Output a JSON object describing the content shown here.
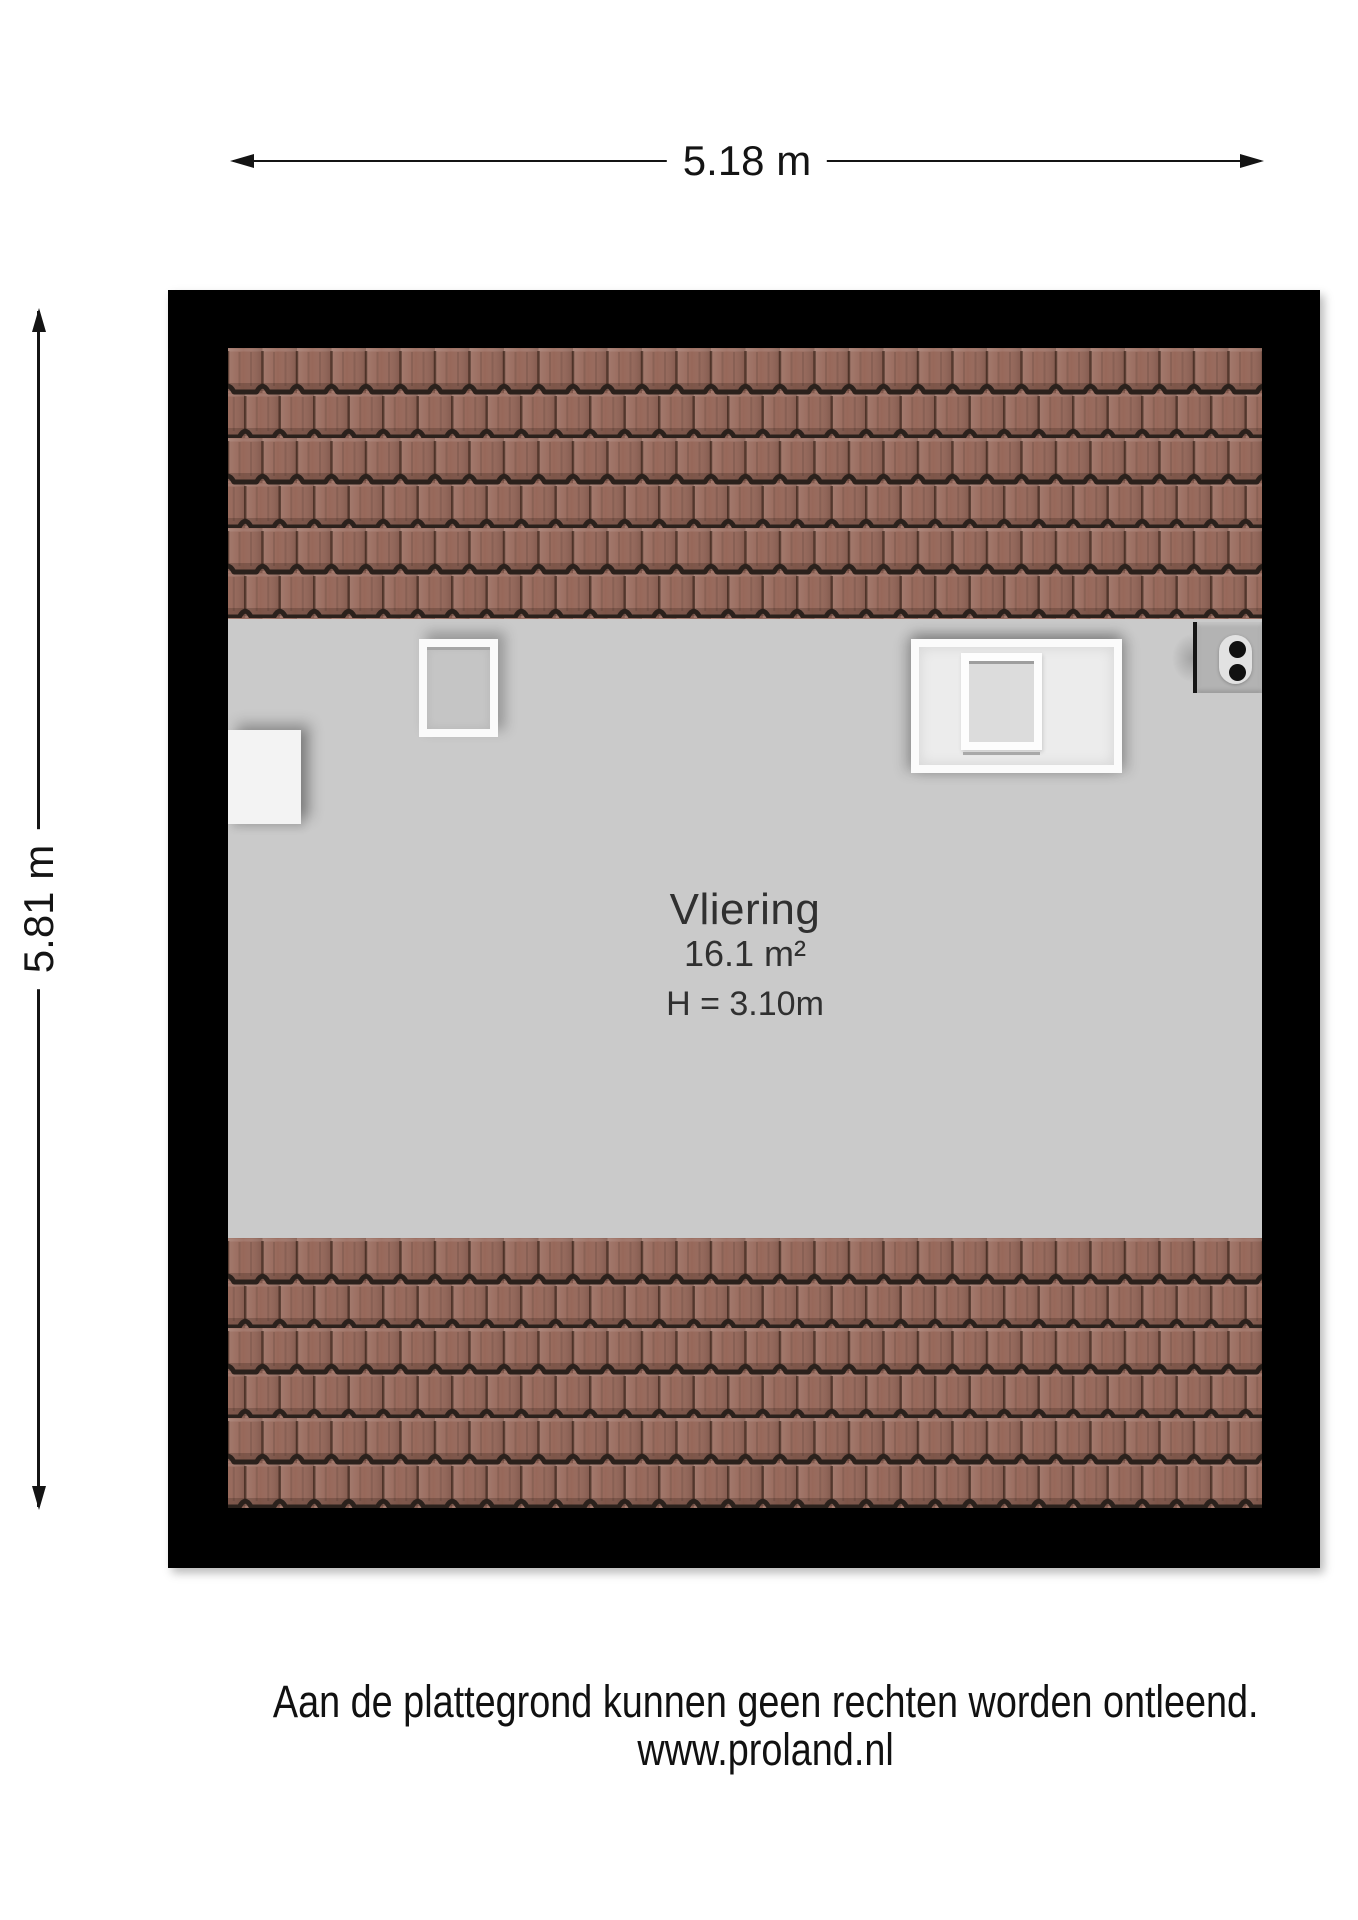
{
  "dimensions": {
    "width_label": "5.18 m",
    "height_label": "5.81 m"
  },
  "room": {
    "name": "Vliering",
    "area": "16.1 m²",
    "ceiling_height": "H = 3.10m"
  },
  "footer": {
    "line1": "Aan de plattegrond kunnen geen rechten worden ontleend.",
    "line2": "www.proland.nl"
  },
  "colors": {
    "exterior_wall": "#000000",
    "floor": "#cacaca",
    "roof_tile": "#97685a",
    "roof_tile_gap": "#2b211c",
    "dimension_line": "#141414",
    "label_text": "#303030"
  }
}
